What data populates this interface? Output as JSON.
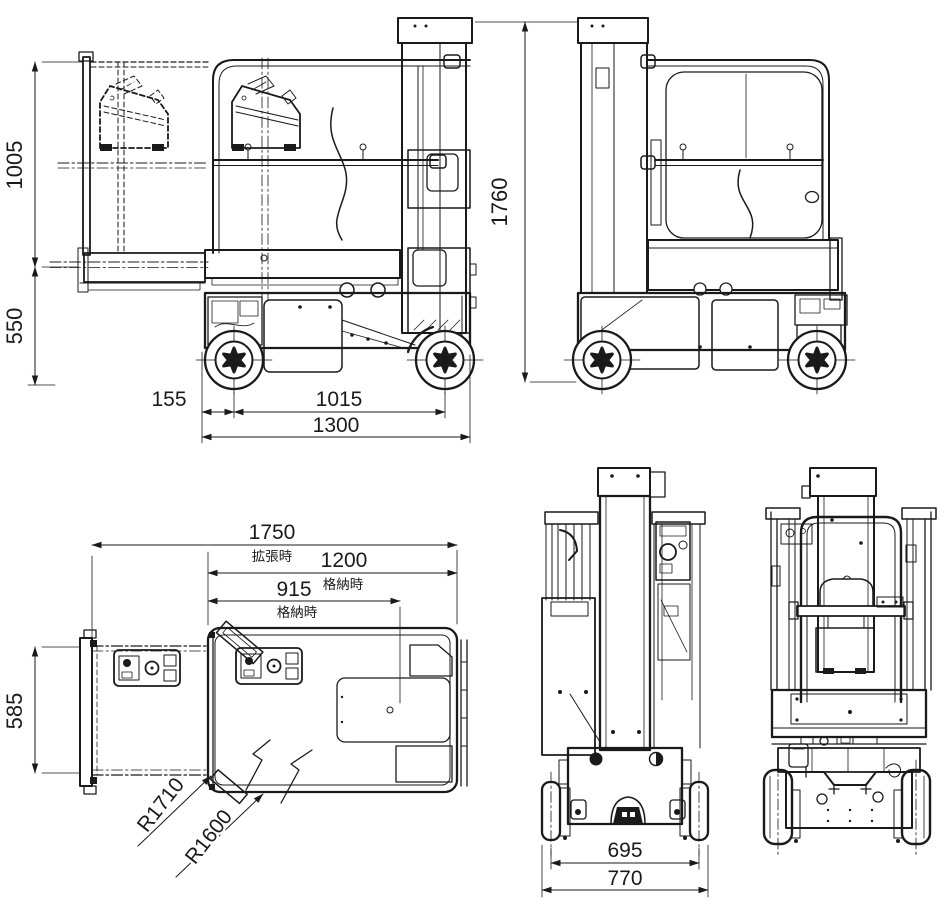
{
  "colors": {
    "background": "#ffffff",
    "line": "#1a1a1a"
  },
  "dims": {
    "side": {
      "platform_height": "1005",
      "chassis_height": "550",
      "front_overhang": "155",
      "wheelbase": "1015",
      "overall_length": "1300",
      "overall_height": "1760"
    },
    "plan": {
      "length_extended": "1750",
      "note_extended": "拡張時",
      "length_stowed": "1200",
      "note_stowed_1": "格納時",
      "platform_length_stowed": "915",
      "note_stowed_2": "格納時",
      "deck_width": "585",
      "turning_radius_outer": "R1710",
      "turning_radius_inner": "R1600"
    },
    "front": {
      "track_width": "695",
      "overall_width": "770"
    }
  }
}
